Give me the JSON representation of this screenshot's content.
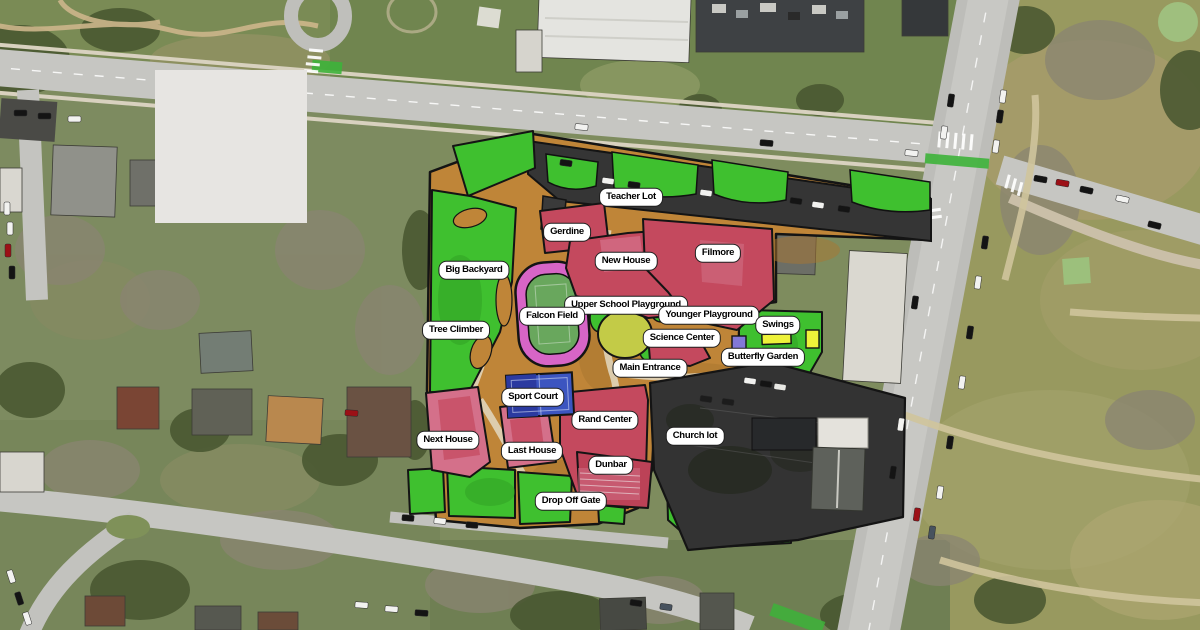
{
  "map": {
    "type": "campus-satellite-map",
    "labels": [
      {
        "text": "Teacher Lot",
        "x": 631,
        "y": 197
      },
      {
        "text": "Gerdine",
        "x": 567,
        "y": 232
      },
      {
        "text": "New House",
        "x": 626,
        "y": 261
      },
      {
        "text": "Filmore",
        "x": 718,
        "y": 253
      },
      {
        "text": "Big Backyard",
        "x": 474,
        "y": 270
      },
      {
        "text": "Upper School Playground",
        "x": 626,
        "y": 305
      },
      {
        "text": "Younger Playground",
        "x": 709,
        "y": 315
      },
      {
        "text": "Swings",
        "x": 778,
        "y": 325
      },
      {
        "text": "Falcon Field",
        "x": 552,
        "y": 316
      },
      {
        "text": "Tree Climber",
        "x": 456,
        "y": 330
      },
      {
        "text": "Science Center",
        "x": 682,
        "y": 338
      },
      {
        "text": "Butterfly Garden",
        "x": 763,
        "y": 357
      },
      {
        "text": "Main Entrance",
        "x": 650,
        "y": 368
      },
      {
        "text": "Sport Court",
        "x": 533,
        "y": 397
      },
      {
        "text": "Rand Center",
        "x": 605,
        "y": 420
      },
      {
        "text": "Church lot",
        "x": 695,
        "y": 436
      },
      {
        "text": "Next House",
        "x": 448,
        "y": 440
      },
      {
        "text": "Last House",
        "x": 532,
        "y": 451
      },
      {
        "text": "Dunbar",
        "x": 611,
        "y": 465
      },
      {
        "text": "Drop Off Gate",
        "x": 571,
        "y": 501
      }
    ],
    "colors": {
      "overlay_green": "#3fc02f",
      "overlay_tan": "#bf8538",
      "building_red": "#c4495e",
      "building_pink": "#d4708a",
      "parking_dark": "#353535",
      "track_pink": "#d765c6",
      "field_green": "#69a75d",
      "court_blue": "#3c55c0",
      "playground_yellow_green": "#c3cb47",
      "equipment_yellow": "#eef23a",
      "structure_purple": "#8278d8",
      "label_bg": "#ffffff",
      "label_text": "#000000",
      "outline_black": "#141414"
    }
  }
}
